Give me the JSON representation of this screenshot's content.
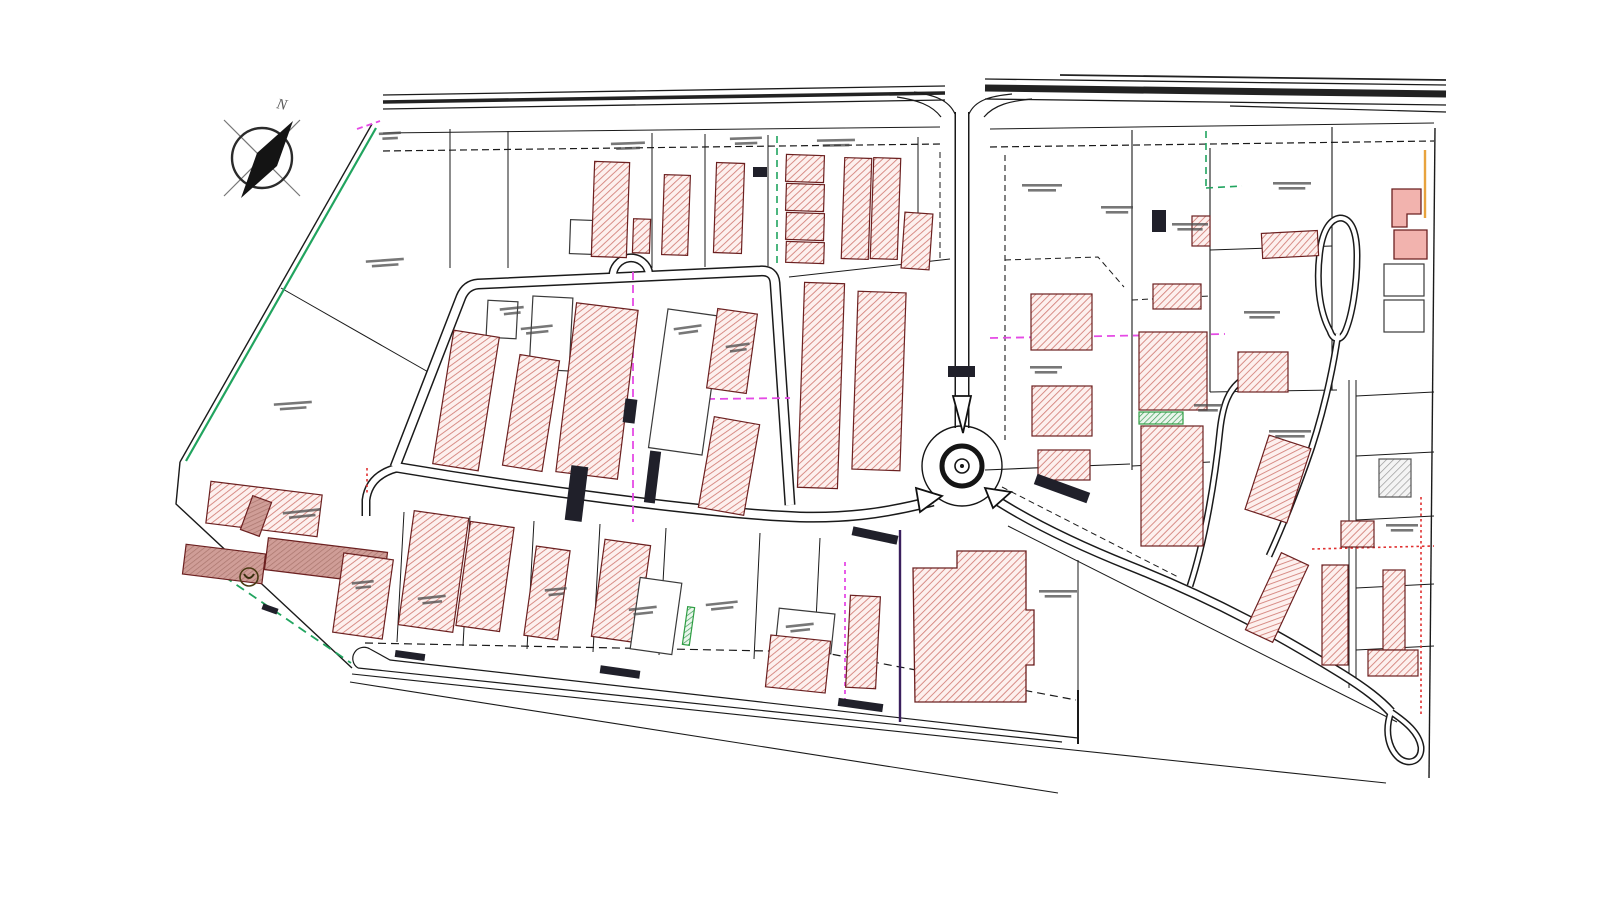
{
  "compass": {
    "label": "N"
  },
  "colors": {
    "road_casing": "#1a1a1a",
    "hatch_red_stroke": "#d4837c",
    "hatch_red_bg": "#fdf0ee",
    "building_outline": "#6b2020",
    "mauve": "#cf9d97",
    "pink": "#f2b3ae",
    "gray": "#9a9a9a",
    "green": "#21a45f",
    "magenta": "#e54ae5",
    "red_dot": "#e03030",
    "orange": "#e8a33d",
    "purple": "#3a1f5d",
    "dark_marking": "#20202a"
  },
  "map": {
    "strokes": [
      {
        "d": "M383,95 L945,86",
        "w": 1.3
      },
      {
        "d": "M383,109 L945,100",
        "w": 1.3
      },
      {
        "d": "M383,102 L945,93",
        "w": 3.6,
        "c": "#222222",
        "n": "highway-band"
      },
      {
        "d": "M985,79 L1446,85",
        "w": 1.3
      },
      {
        "d": "M985,88 L1446,94",
        "w": 7,
        "c": "#222222",
        "n": "highway-band"
      },
      {
        "d": "M985,99 L1446,105",
        "w": 1.3
      },
      {
        "d": "M1230,106 L1446,112",
        "w": 1.2
      },
      {
        "d": "M1060,75 L1446,80",
        "w": 1.8,
        "c": "#222222",
        "n": "highway-band"
      },
      {
        "d": "M955,114 C949,100 934,95 914,92",
        "w": 1.2
      },
      {
        "d": "M969,114 C975,100 991,96 1012,94",
        "w": 1.2
      },
      {
        "d": "M941,117 C932,105 917,100 897,97",
        "w": 1.2
      },
      {
        "d": "M984,117 C994,105 1010,101 1032,99",
        "w": 1.2
      },
      {
        "d": "M372,124 L180,462",
        "w": 1.4,
        "n": "site-boundary"
      },
      {
        "d": "M180,462 L176,504 L352,668",
        "w": 1.4,
        "n": "site-boundary"
      },
      {
        "d": "M383,133 L940,127",
        "w": 1
      },
      {
        "d": "M990,129 L1434,123",
        "w": 1
      },
      {
        "d": "M383,151 L940,144",
        "w": 1.2,
        "da": "7,4"
      },
      {
        "d": "M990,147 L1434,141",
        "w": 1.2,
        "da": "7,4"
      },
      {
        "d": "M1435,128 L1429,778",
        "w": 1.4,
        "n": "site-boundary"
      },
      {
        "d": "M281,288 L430,373",
        "w": 1
      },
      {
        "d": "M450,129 L450,268",
        "w": 1
      },
      {
        "d": "M508,131 L508,268",
        "w": 1
      },
      {
        "d": "M652,133 L652,268",
        "w": 1
      },
      {
        "d": "M705,134 L705,267",
        "w": 1
      },
      {
        "d": "M768,135 L768,266",
        "w": 1
      },
      {
        "d": "M918,137 L918,263",
        "w": 1
      },
      {
        "d": "M940,152 L940,262",
        "w": 1,
        "da": "6,4"
      },
      {
        "d": "M789,277 L950,259",
        "w": 1
      },
      {
        "d": "M1005,155 L1005,440",
        "w": 1.1,
        "da": "6,4"
      },
      {
        "d": "M1132,130 L1132,470",
        "w": 1.1
      },
      {
        "d": "M1210,148 L1210,392",
        "w": 1.1
      },
      {
        "d": "M1332,127 L1332,390",
        "w": 1.1
      },
      {
        "d": "M1005,260 L1098,257 L1124,287",
        "w": 1,
        "da": "6,4"
      },
      {
        "d": "M985,470 L1130,464",
        "w": 1.1
      },
      {
        "d": "M1132,300 L1210,296",
        "w": 1,
        "da": "6,4"
      },
      {
        "d": "M1210,250 L1332,246",
        "w": 1
      },
      {
        "d": "M1210,392 L1337,390",
        "w": 1
      },
      {
        "d": "M1132,466 L1210,462",
        "w": 1
      },
      {
        "d": "M1349,380 L1349,688",
        "w": 1
      },
      {
        "d": "M1356,380 L1356,688",
        "w": 1
      },
      {
        "d": "M1356,396 L1434,392",
        "w": 1
      },
      {
        "d": "M1356,456 L1434,452",
        "w": 1
      },
      {
        "d": "M1356,520 L1434,516",
        "w": 1
      },
      {
        "d": "M1356,588 L1434,584",
        "w": 1
      },
      {
        "d": "M1356,650 L1434,646",
        "w": 1
      },
      {
        "d": "M404,512 L397,642",
        "w": 1
      },
      {
        "d": "M470,516 L463,646",
        "w": 1
      },
      {
        "d": "M534,521 L527,649",
        "w": 1
      },
      {
        "d": "M600,524 L593,652",
        "w": 1
      },
      {
        "d": "M666,528 L659,655",
        "w": 1
      },
      {
        "d": "M760,533 L754,659",
        "w": 1
      },
      {
        "d": "M820,538 L814,662",
        "w": 1
      },
      {
        "d": "M365,643 L820,652 L1076,700",
        "w": 1.2,
        "da": "8,5"
      },
      {
        "d": "M1078,690 L1078,744",
        "w": 2
      },
      {
        "d": "M1078,560 L1078,690",
        "w": 1
      },
      {
        "d": "M370,649 L390,660 L1078,738",
        "w": 1.2,
        "n": "strip-road-edge"
      },
      {
        "d": "M358,668 L1062,742",
        "w": 1.2,
        "n": "strip-road-edge"
      },
      {
        "d": "M370,649 A11,11 0 0 0 358,668",
        "w": 1.2,
        "n": "strip-road-edge"
      },
      {
        "d": "M352,674 L1386,783",
        "w": 1.1
      },
      {
        "d": "M350,682 L1058,793",
        "w": 1.1
      },
      {
        "d": "M1008,526 L1397,722",
        "w": 1
      },
      {
        "d": "M1002,487 L1180,578",
        "w": 1,
        "da": "6,4"
      },
      {
        "d": "M376,128 L186,461",
        "c": "green",
        "w": 2.2,
        "n": "green-boundary"
      },
      {
        "d": "M187,551 L351,663",
        "c": "green",
        "w": 1.8,
        "da": "9,6",
        "n": "green-dashed-boundary"
      },
      {
        "d": "M777,136 L777,264",
        "c": "green",
        "w": 1.6,
        "da": "7,5",
        "n": "green-dashed-boundary"
      },
      {
        "d": "M1206,131 L1206,188",
        "c": "green",
        "w": 1.6,
        "da": "7,5",
        "n": "green-dashed-boundary"
      },
      {
        "d": "M1206,188 L1242,186",
        "c": "green",
        "w": 1.6,
        "da": "7,5",
        "n": "green-dashed-boundary"
      },
      {
        "d": "M357,129 L380,121",
        "c": "magenta",
        "w": 1.8,
        "da": "6,4",
        "n": "magenta-dashed-line"
      },
      {
        "d": "M633,272 L633,522",
        "c": "magenta",
        "w": 1.8,
        "da": "8,5",
        "n": "magenta-dashed-line"
      },
      {
        "d": "M707,399 L790,398",
        "c": "magenta",
        "w": 1.8,
        "da": "8,5",
        "n": "magenta-dashed-line"
      },
      {
        "d": "M990,338 L1225,334",
        "c": "magenta",
        "w": 1.8,
        "da": "8,5",
        "n": "magenta-dashed-line"
      },
      {
        "d": "M845,562 L845,700",
        "c": "magenta",
        "w": 1.8,
        "da": "4,4",
        "n": "magenta-dashed-line"
      },
      {
        "d": "M900,530 L900,722",
        "c": "purple",
        "w": 2.4,
        "n": "purple-line"
      },
      {
        "d": "M1421,497 L1421,716",
        "c": "red_dot",
        "w": 1.6,
        "da": "2.5,3",
        "n": "red-dotted-boundary"
      },
      {
        "d": "M1312,549 L1434,546",
        "c": "red_dot",
        "w": 1.6,
        "da": "2.5,3",
        "n": "red-dotted-boundary"
      },
      {
        "d": "M367,468 L367,494",
        "c": "red_dot",
        "w": 1.6,
        "da": "2.5,3",
        "n": "red-dotted-boundary"
      },
      {
        "d": "M1425,150 L1425,218",
        "c": "orange",
        "w": 2.4,
        "n": "orange-line"
      },
      {
        "d": "M357,590 L368,628",
        "c": "orange",
        "w": 1.6,
        "da": "5,4",
        "n": "orange-dashed-line"
      }
    ],
    "roads": [
      [
        "M395,467 L461,297 Q466,285 478,284 L760,271 Q774,270 775,283 L790,505",
        11
      ],
      [
        "M933,501 C880,515 840,518 800,517 C700,513 520,488 395,467",
        11
      ],
      [
        "M397,468 C378,473 368,484 366,500 L366,516",
        9
      ],
      [
        "M962,112 L962,428",
        15
      ],
      [
        "M993,498 C1030,522 1080,546 1130,566 C1220,602 1282,637 1342,674 C1366,689 1380,700 1391,712",
        10
      ],
      [
        "M1391,712 C1406,722 1419,733 1421,747 C1422,761 1409,766 1399,758 C1389,749 1384,732 1391,712",
        7
      ],
      [
        "M613,278 A18,18 0 0 1 649,274",
        9
      ],
      [
        "M1190,586 C1205,540 1215,480 1220,430 C1223,404 1229,389 1242,380",
        7
      ],
      [
        "M1330,331 C1319,311 1316,281 1320,251 C1323,229 1331,219 1340,218 C1351,218 1357,231 1357,256 C1357,286 1352,316 1345,332 C1340,342 1333,340 1330,331 Z",
        7
      ],
      [
        "M1338,334 C1333,370 1322,420 1306,464 C1293,500 1281,530 1269,556",
        7
      ]
    ],
    "roundabout": {
      "cx": 962,
      "cy": 466,
      "rings": [
        [
          40,
          1.4,
          "none"
        ],
        [
          20,
          5,
          "white"
        ],
        [
          7,
          1.6,
          "white"
        ],
        [
          2,
          0,
          "dot"
        ]
      ],
      "islands": [
        "953,396 971,396 963,433",
        "916,488 942,496 920,512",
        "985,488 1011,492 993,508"
      ]
    },
    "buildings": [
      [
        570,
        220,
        22,
        34,
        2,
        "white"
      ],
      [
        593,
        162,
        35,
        95,
        2
      ],
      [
        633,
        219,
        17,
        34,
        2
      ],
      [
        663,
        175,
        26,
        80,
        2
      ],
      [
        715,
        163,
        28,
        90,
        2
      ],
      [
        786,
        155,
        38,
        27,
        2
      ],
      [
        786,
        184,
        38,
        27,
        2
      ],
      [
        786,
        213,
        38,
        27,
        2
      ],
      [
        786,
        242,
        38,
        21,
        2
      ],
      [
        843,
        158,
        27,
        101,
        2
      ],
      [
        872,
        158,
        27,
        101,
        2
      ],
      [
        903,
        213,
        28,
        56,
        4
      ],
      [
        1031,
        294,
        61,
        56,
        0
      ],
      [
        1032,
        386,
        60,
        50,
        0
      ],
      [
        1038,
        450,
        52,
        30,
        0
      ],
      [
        1153,
        284,
        48,
        25,
        0
      ],
      [
        1139,
        332,
        68,
        78,
        0
      ],
      [
        1139,
        412,
        44,
        12,
        0,
        "green"
      ],
      [
        1141,
        426,
        62,
        120,
        0
      ],
      [
        1192,
        216,
        18,
        30,
        0
      ],
      [
        1262,
        232,
        56,
        25,
        -3
      ],
      [
        1238,
        352,
        50,
        40,
        0
      ],
      [
        1256,
        440,
        44,
        78,
        18
      ],
      [
        1379,
        459,
        32,
        38,
        0,
        "gray"
      ],
      [
        1341,
        521,
        33,
        26,
        0
      ],
      [
        1384,
        264,
        40,
        32,
        0,
        "white"
      ],
      [
        1384,
        300,
        40,
        32,
        0,
        "white"
      ],
      [
        487,
        301,
        30,
        37,
        3,
        "white"
      ],
      [
        531,
        297,
        40,
        73,
        3,
        "white"
      ],
      [
        658,
        312,
        54,
        140,
        8,
        "white"
      ],
      [
        443,
        333,
        46,
        135,
        9
      ],
      [
        511,
        357,
        40,
        112,
        9
      ],
      [
        566,
        306,
        62,
        170,
        7
      ],
      [
        712,
        311,
        40,
        80,
        8
      ],
      [
        706,
        420,
        46,
        92,
        10
      ],
      [
        801,
        283,
        40,
        205,
        2
      ],
      [
        855,
        292,
        48,
        178,
        2
      ],
      [
        208,
        488,
        112,
        42,
        7
      ],
      [
        246,
        498,
        20,
        36,
        20,
        "mauve"
      ],
      [
        184,
        549,
        80,
        30,
        7,
        "mauve"
      ],
      [
        266,
        545,
        120,
        32,
        7,
        "mauve"
      ],
      [
        338,
        556,
        50,
        80,
        8
      ],
      [
        406,
        514,
        55,
        115,
        8
      ],
      [
        463,
        524,
        44,
        105,
        8
      ],
      [
        530,
        548,
        34,
        90,
        8
      ],
      [
        598,
        542,
        46,
        98,
        8
      ],
      [
        635,
        580,
        42,
        72,
        8,
        "white"
      ],
      [
        685,
        607,
        7,
        38,
        8,
        "green"
      ],
      [
        777,
        611,
        56,
        40,
        6,
        "white"
      ],
      [
        768,
        638,
        60,
        52,
        6
      ],
      [
        848,
        596,
        30,
        92,
        3
      ],
      [
        1262,
        555,
        30,
        85,
        25
      ],
      [
        1322,
        565,
        26,
        100,
        0
      ],
      [
        1383,
        570,
        22,
        80,
        0
      ],
      [
        1368,
        650,
        50,
        26,
        0
      ]
    ],
    "polys": [
      [
        "913,568 957,568 957,551 1026,551 1026,610 1034,610 1034,665 1026,665 1026,702 915,702",
        "red"
      ],
      [
        "1392,189 1421,189 1421,214 1407,214 1407,227 1392,227",
        "pink"
      ],
      [
        "1394,230 1427,230 1427,259 1394,259",
        "pink"
      ]
    ],
    "darks": [
      [
        948,
        366,
        27,
        11,
        0
      ],
      [
        852,
        531,
        46,
        9,
        12
      ],
      [
        1034,
        483,
        56,
        11,
        20
      ],
      [
        568,
        466,
        17,
        55,
        7
      ],
      [
        647,
        451,
        11,
        52,
        7
      ],
      [
        624,
        399,
        12,
        24,
        7
      ],
      [
        395,
        652,
        30,
        7,
        8
      ],
      [
        600,
        668,
        40,
        8,
        8
      ],
      [
        838,
        701,
        45,
        8,
        8
      ],
      [
        262,
        606,
        16,
        6,
        20
      ],
      [
        1152,
        210,
        14,
        22,
        0
      ],
      [
        753,
        167,
        14,
        10,
        0
      ]
    ],
    "labels": [
      [
        385,
        263,
        38,
        -4
      ],
      [
        293,
        406,
        38,
        -4
      ],
      [
        512,
        311,
        24,
        -6
      ],
      [
        537,
        330,
        32,
        -6
      ],
      [
        628,
        146,
        34,
        -2
      ],
      [
        746,
        141,
        32,
        -2
      ],
      [
        836,
        143,
        38,
        -1
      ],
      [
        1042,
        188,
        40,
        0
      ],
      [
        1117,
        210,
        32,
        0
      ],
      [
        1190,
        227,
        36,
        0
      ],
      [
        1292,
        186,
        38,
        0
      ],
      [
        1262,
        315,
        36,
        0
      ],
      [
        1046,
        370,
        32,
        0
      ],
      [
        1208,
        408,
        28,
        0
      ],
      [
        1290,
        434,
        42,
        0
      ],
      [
        1402,
        528,
        32,
        0
      ],
      [
        1058,
        594,
        38,
        0
      ],
      [
        688,
        330,
        28,
        -8
      ],
      [
        738,
        348,
        24,
        -8
      ],
      [
        390,
        136,
        22,
        -3
      ],
      [
        643,
        611,
        28,
        -6
      ],
      [
        432,
        600,
        28,
        -6
      ],
      [
        363,
        585,
        22,
        -6
      ],
      [
        556,
        592,
        22,
        -6
      ],
      [
        302,
        514,
        38,
        -6
      ],
      [
        722,
        606,
        32,
        -6
      ],
      [
        800,
        628,
        28,
        -6
      ]
    ],
    "symbols": [
      {
        "type": "tree-circle",
        "cx": 249,
        "cy": 577,
        "r": 9
      }
    ]
  }
}
